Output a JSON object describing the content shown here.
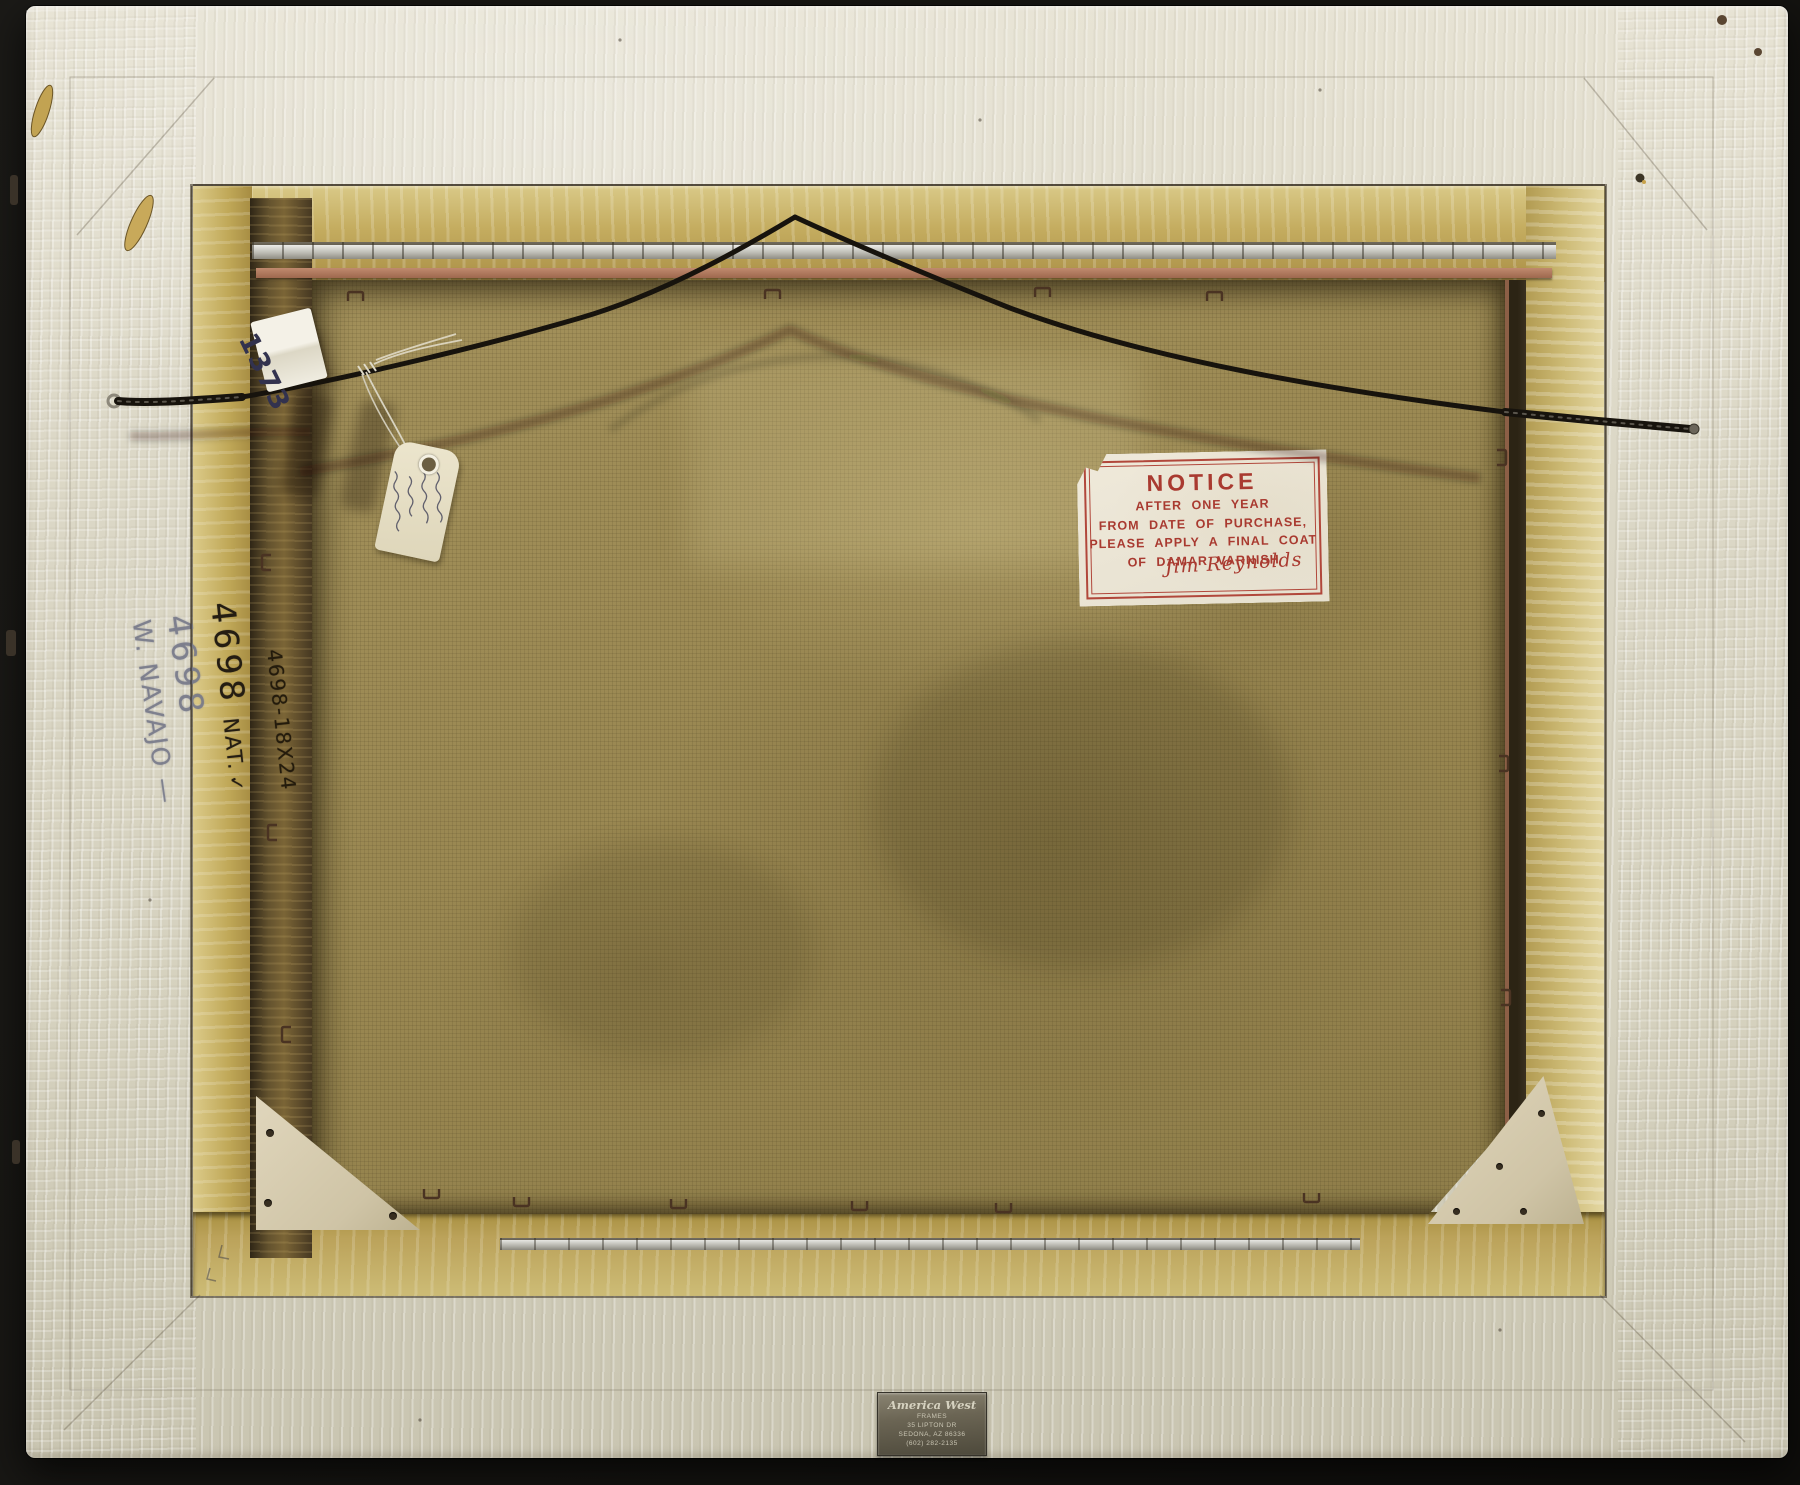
{
  "notice_label": {
    "title": "NOTICE",
    "line1": "AFTER ONE YEAR",
    "line2": "FROM DATE OF PURCHASE,",
    "line3": "PLEASE APPLY A FINAL COAT",
    "line4": "OF DAMAR VARNISH",
    "signature": "Jim Reynolds"
  },
  "maker_plaque": {
    "name": "America West",
    "line2": "FRAMES",
    "line3": "35 LIPTON DR",
    "line4": "SEDONA, AZ 86336",
    "line5": "(602) 282-2135"
  },
  "frame_markings": {
    "pencil_number": "4698",
    "pencil_title": "W. NAVAJO —",
    "inventory_number": "4698",
    "inventory_suffix": "NAT.",
    "inventory_check": "✓",
    "size_mark": "4698-18X24"
  },
  "hanging_wire": {
    "sticker_number": "1373"
  },
  "colors": {
    "backdrop": "#151411",
    "frame_white": "#dcd8c7",
    "liner_gold": "#c4ac5f",
    "board_brown": "#988650",
    "label_red": "#a93a30",
    "plaque_bronze": "#6b6554",
    "wire_black": "#17130d",
    "tag_cream": "#ece5cd",
    "salmon_strip": "#b07a5e",
    "silver_strip": "#bdbcb4"
  }
}
